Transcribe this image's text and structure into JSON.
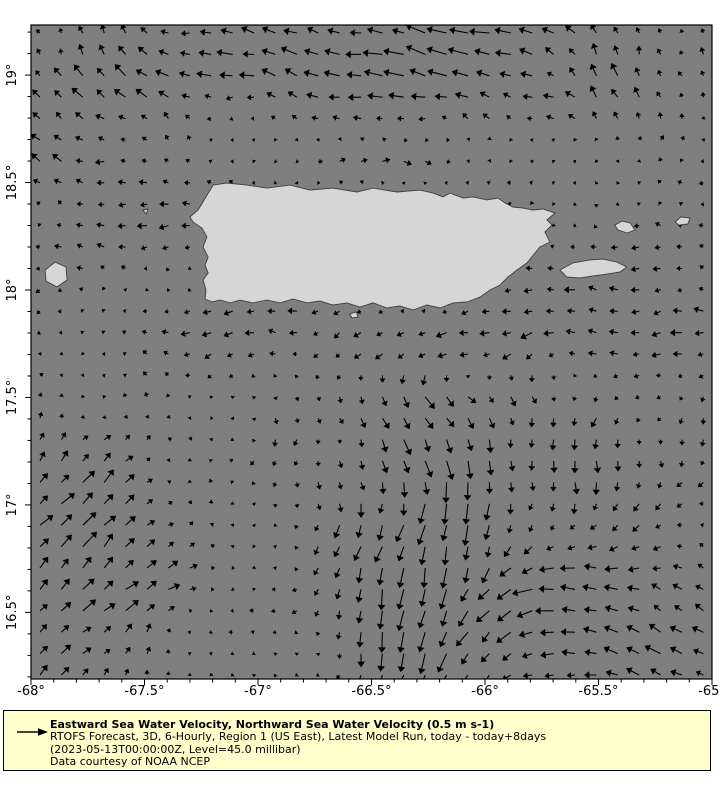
{
  "colors": {
    "ocean": "#7f7f7f",
    "land": "#d6d6d6",
    "coast": "#3f3f3f",
    "arrow": "#000000",
    "frame": "#000000",
    "legend_bg": "#ffffcc",
    "text": "#000000",
    "page_bg": "#ffffff"
  },
  "legend": {
    "title": "Eastward Sea Water Velocity, Northward Sea Water Velocity (0.5 m s-1)",
    "line2": "RTOFS Forecast, 3D, 6-Hourly, Region 1 (US East), Latest Model Run, today - today+8days",
    "line3": "(2023-05-13T00:00:00Z, Level=45.0 millibar)",
    "line4": "Data courtesy of NOAA NCEP",
    "reference_arrow": "0.5 m s-1"
  },
  "chart_data": {
    "type": "quiver",
    "title": "Eastward Sea Water Velocity, Northward Sea Water Velocity",
    "units": "m s-1",
    "reference_value": 0.5,
    "x_range": [
      -68,
      -65
    ],
    "y_range": [
      16.19,
      19.233
    ],
    "x_ticks": [
      {
        "value": -68,
        "label": "-68°"
      },
      {
        "value": -67.5,
        "label": "-67.5°"
      },
      {
        "value": -67,
        "label": "-67°"
      },
      {
        "value": -66.5,
        "label": "-66.5°"
      },
      {
        "value": -66,
        "label": "-66°"
      },
      {
        "value": -65.5,
        "label": "-65.5°"
      },
      {
        "value": -65,
        "label": "-65°"
      }
    ],
    "y_ticks": [
      {
        "value": 19,
        "label": "19°"
      },
      {
        "value": 18.5,
        "label": "18.5°"
      },
      {
        "value": 18,
        "label": "18°"
      },
      {
        "value": 17.5,
        "label": "17.5°"
      },
      {
        "value": 17,
        "label": "17°"
      },
      {
        "value": 16.5,
        "label": "16.5°"
      }
    ],
    "minor_tick_step": 0.1,
    "grid_cols": 32,
    "grid_rows": 31,
    "background_flow": {
      "dir": 270,
      "speed": 0.055
    },
    "flow_features": [
      {
        "name": "north-offshore-westward",
        "lon": -66.55,
        "lat": 19.07,
        "dir": 285,
        "speed": 0.32,
        "rx": 0.66,
        "ry": 0.19
      },
      {
        "name": "north-offshore-westward-east",
        "lon": -65.93,
        "lat": 19.07,
        "dir": 275,
        "speed": 0.15,
        "rx": 0.3,
        "ry": 0.2
      },
      {
        "name": "northwest-corner-northward",
        "lon": -67.83,
        "lat": 19.02,
        "dir": 0,
        "speed": 0.22,
        "rx": 0.26,
        "ry": 0.28
      },
      {
        "name": "north-coast-eastward",
        "lon": -66.64,
        "lat": 18.65,
        "dir": 85,
        "speed": 0.22,
        "rx": 0.57,
        "ry": 0.1
      },
      {
        "name": "northeast-corner-ne",
        "lon": -65.32,
        "lat": 19.02,
        "dir": 20,
        "speed": 0.2,
        "rx": 0.35,
        "ry": 0.23
      },
      {
        "name": "mona-passage-westward",
        "lon": -67.61,
        "lat": 18.56,
        "dir": 275,
        "speed": 0.16,
        "rx": 0.4,
        "ry": 0.28
      },
      {
        "name": "south-coast-westward",
        "lon": -66.46,
        "lat": 17.77,
        "dir": 270,
        "speed": 0.22,
        "rx": 0.7,
        "ry": 0.12
      },
      {
        "name": "south-southeast-flow",
        "lon": -66.37,
        "lat": 17.49,
        "dir": 130,
        "speed": 0.24,
        "rx": 0.4,
        "ry": 0.23
      },
      {
        "name": "central-southward",
        "lon": -66.24,
        "lat": 17.02,
        "dir": 185,
        "speed": 0.2,
        "rx": 0.4,
        "ry": 0.28
      },
      {
        "name": "southern-jet",
        "lon": -66.29,
        "lat": 16.44,
        "dir": 182,
        "speed": 0.5,
        "rx": 0.26,
        "ry": 0.33
      },
      {
        "name": "southeast-westward",
        "lon": -65.67,
        "lat": 16.51,
        "dir": 275,
        "speed": 0.3,
        "rx": 0.31,
        "ry": 0.28
      },
      {
        "name": "southwest-northeastward",
        "lon": -67.87,
        "lat": 16.56,
        "dir": 45,
        "speed": 0.32,
        "rx": 0.31,
        "ry": 0.51
      },
      {
        "name": "west-low-eastward",
        "lon": -67.48,
        "lat": 16.74,
        "dir": 80,
        "speed": 0.16,
        "rx": 0.26,
        "ry": 0.23
      },
      {
        "name": "southeast-corner-northwestward",
        "lon": -65.1,
        "lat": 16.37,
        "dir": 320,
        "speed": 0.22,
        "rx": 0.22,
        "ry": 0.28
      },
      {
        "name": "east-mid-southward",
        "lon": -65.27,
        "lat": 17.21,
        "dir": 185,
        "speed": 0.14,
        "rx": 0.31,
        "ry": 0.23
      },
      {
        "name": "east-westward-band",
        "lon": -65.32,
        "lat": 17.95,
        "dir": 275,
        "speed": 0.17,
        "rx": 0.35,
        "ry": 0.19
      },
      {
        "name": "east-mid-ssE",
        "lon": -65.85,
        "lat": 17.16,
        "dir": 140,
        "speed": 0.13,
        "rx": 0.45,
        "ry": 0.25
      },
      {
        "name": "west-mid-northeast",
        "lon": -67.78,
        "lat": 17.12,
        "dir": 50,
        "speed": 0.15,
        "rx": 0.3,
        "ry": 0.3
      }
    ],
    "land": {
      "puerto_rico": [
        [
          -67.3,
          18.34
        ],
        [
          -67.264,
          18.372
        ],
        [
          -67.198,
          18.488
        ],
        [
          -67.137,
          18.498
        ],
        [
          -67.048,
          18.488
        ],
        [
          -66.96,
          18.474
        ],
        [
          -66.859,
          18.488
        ],
        [
          -66.771,
          18.465
        ],
        [
          -66.67,
          18.474
        ],
        [
          -66.564,
          18.456
        ],
        [
          -66.493,
          18.474
        ],
        [
          -66.388,
          18.456
        ],
        [
          -66.286,
          18.465
        ],
        [
          -66.229,
          18.451
        ],
        [
          -66.185,
          18.433
        ],
        [
          -66.154,
          18.451
        ],
        [
          -66.097,
          18.428
        ],
        [
          -66.053,
          18.433
        ],
        [
          -65.991,
          18.419
        ],
        [
          -65.943,
          18.428
        ],
        [
          -65.912,
          18.405
        ],
        [
          -65.877,
          18.386
        ],
        [
          -65.833,
          18.381
        ],
        [
          -65.789,
          18.372
        ],
        [
          -65.745,
          18.377
        ],
        [
          -65.692,
          18.358
        ],
        [
          -65.727,
          18.326
        ],
        [
          -65.705,
          18.302
        ],
        [
          -65.736,
          18.27
        ],
        [
          -65.714,
          18.223
        ],
        [
          -65.758,
          18.2
        ],
        [
          -65.815,
          18.126
        ],
        [
          -65.859,
          18.093
        ],
        [
          -65.899,
          18.06
        ],
        [
          -65.934,
          18.023
        ],
        [
          -65.978,
          18.0
        ],
        [
          -66.022,
          17.967
        ],
        [
          -66.079,
          17.944
        ],
        [
          -66.141,
          17.94
        ],
        [
          -66.198,
          17.916
        ],
        [
          -66.256,
          17.93
        ],
        [
          -66.317,
          17.907
        ],
        [
          -66.374,
          17.926
        ],
        [
          -66.432,
          17.916
        ],
        [
          -66.493,
          17.94
        ],
        [
          -66.551,
          17.921
        ],
        [
          -66.608,
          17.94
        ],
        [
          -66.67,
          17.93
        ],
        [
          -66.727,
          17.949
        ],
        [
          -66.784,
          17.94
        ],
        [
          -66.846,
          17.958
        ],
        [
          -66.903,
          17.94
        ],
        [
          -66.96,
          17.953
        ],
        [
          -67.022,
          17.94
        ],
        [
          -67.079,
          17.953
        ],
        [
          -67.123,
          17.94
        ],
        [
          -67.167,
          17.953
        ],
        [
          -67.202,
          17.944
        ],
        [
          -67.233,
          17.958
        ],
        [
          -67.229,
          18.0
        ],
        [
          -67.242,
          18.047
        ],
        [
          -67.22,
          18.079
        ],
        [
          -67.233,
          18.116
        ],
        [
          -67.22,
          18.153
        ],
        [
          -67.242,
          18.2
        ],
        [
          -67.225,
          18.247
        ],
        [
          -67.247,
          18.288
        ],
        [
          -67.286,
          18.316
        ]
      ],
      "vieques": [
        [
          -65.67,
          18.093
        ],
        [
          -65.612,
          18.126
        ],
        [
          -65.538,
          18.14
        ],
        [
          -65.48,
          18.144
        ],
        [
          -65.419,
          18.13
        ],
        [
          -65.375,
          18.107
        ],
        [
          -65.405,
          18.084
        ],
        [
          -65.463,
          18.074
        ],
        [
          -65.524,
          18.065
        ],
        [
          -65.581,
          18.056
        ],
        [
          -65.639,
          18.06
        ]
      ],
      "culebra": [
        [
          -65.428,
          18.302
        ],
        [
          -65.396,
          18.321
        ],
        [
          -65.361,
          18.312
        ],
        [
          -65.339,
          18.279
        ],
        [
          -65.374,
          18.265
        ],
        [
          -65.414,
          18.279
        ]
      ],
      "st_thomas_west": [
        [
          -65.163,
          18.316
        ],
        [
          -65.137,
          18.34
        ],
        [
          -65.097,
          18.335
        ],
        [
          -65.106,
          18.307
        ],
        [
          -65.145,
          18.302
        ]
      ],
      "mona": [
        [
          -67.938,
          18.093
        ],
        [
          -67.894,
          18.13
        ],
        [
          -67.846,
          18.107
        ],
        [
          -67.841,
          18.047
        ],
        [
          -67.885,
          18.014
        ],
        [
          -67.934,
          18.042
        ]
      ],
      "desecheo": [
        [
          -67.507,
          18.372
        ],
        [
          -67.485,
          18.377
        ],
        [
          -67.493,
          18.353
        ]
      ],
      "caja_de_muertos": [
        [
          -66.595,
          17.888
        ],
        [
          -66.568,
          17.898
        ],
        [
          -66.559,
          17.874
        ],
        [
          -66.586,
          17.87
        ]
      ]
    }
  }
}
